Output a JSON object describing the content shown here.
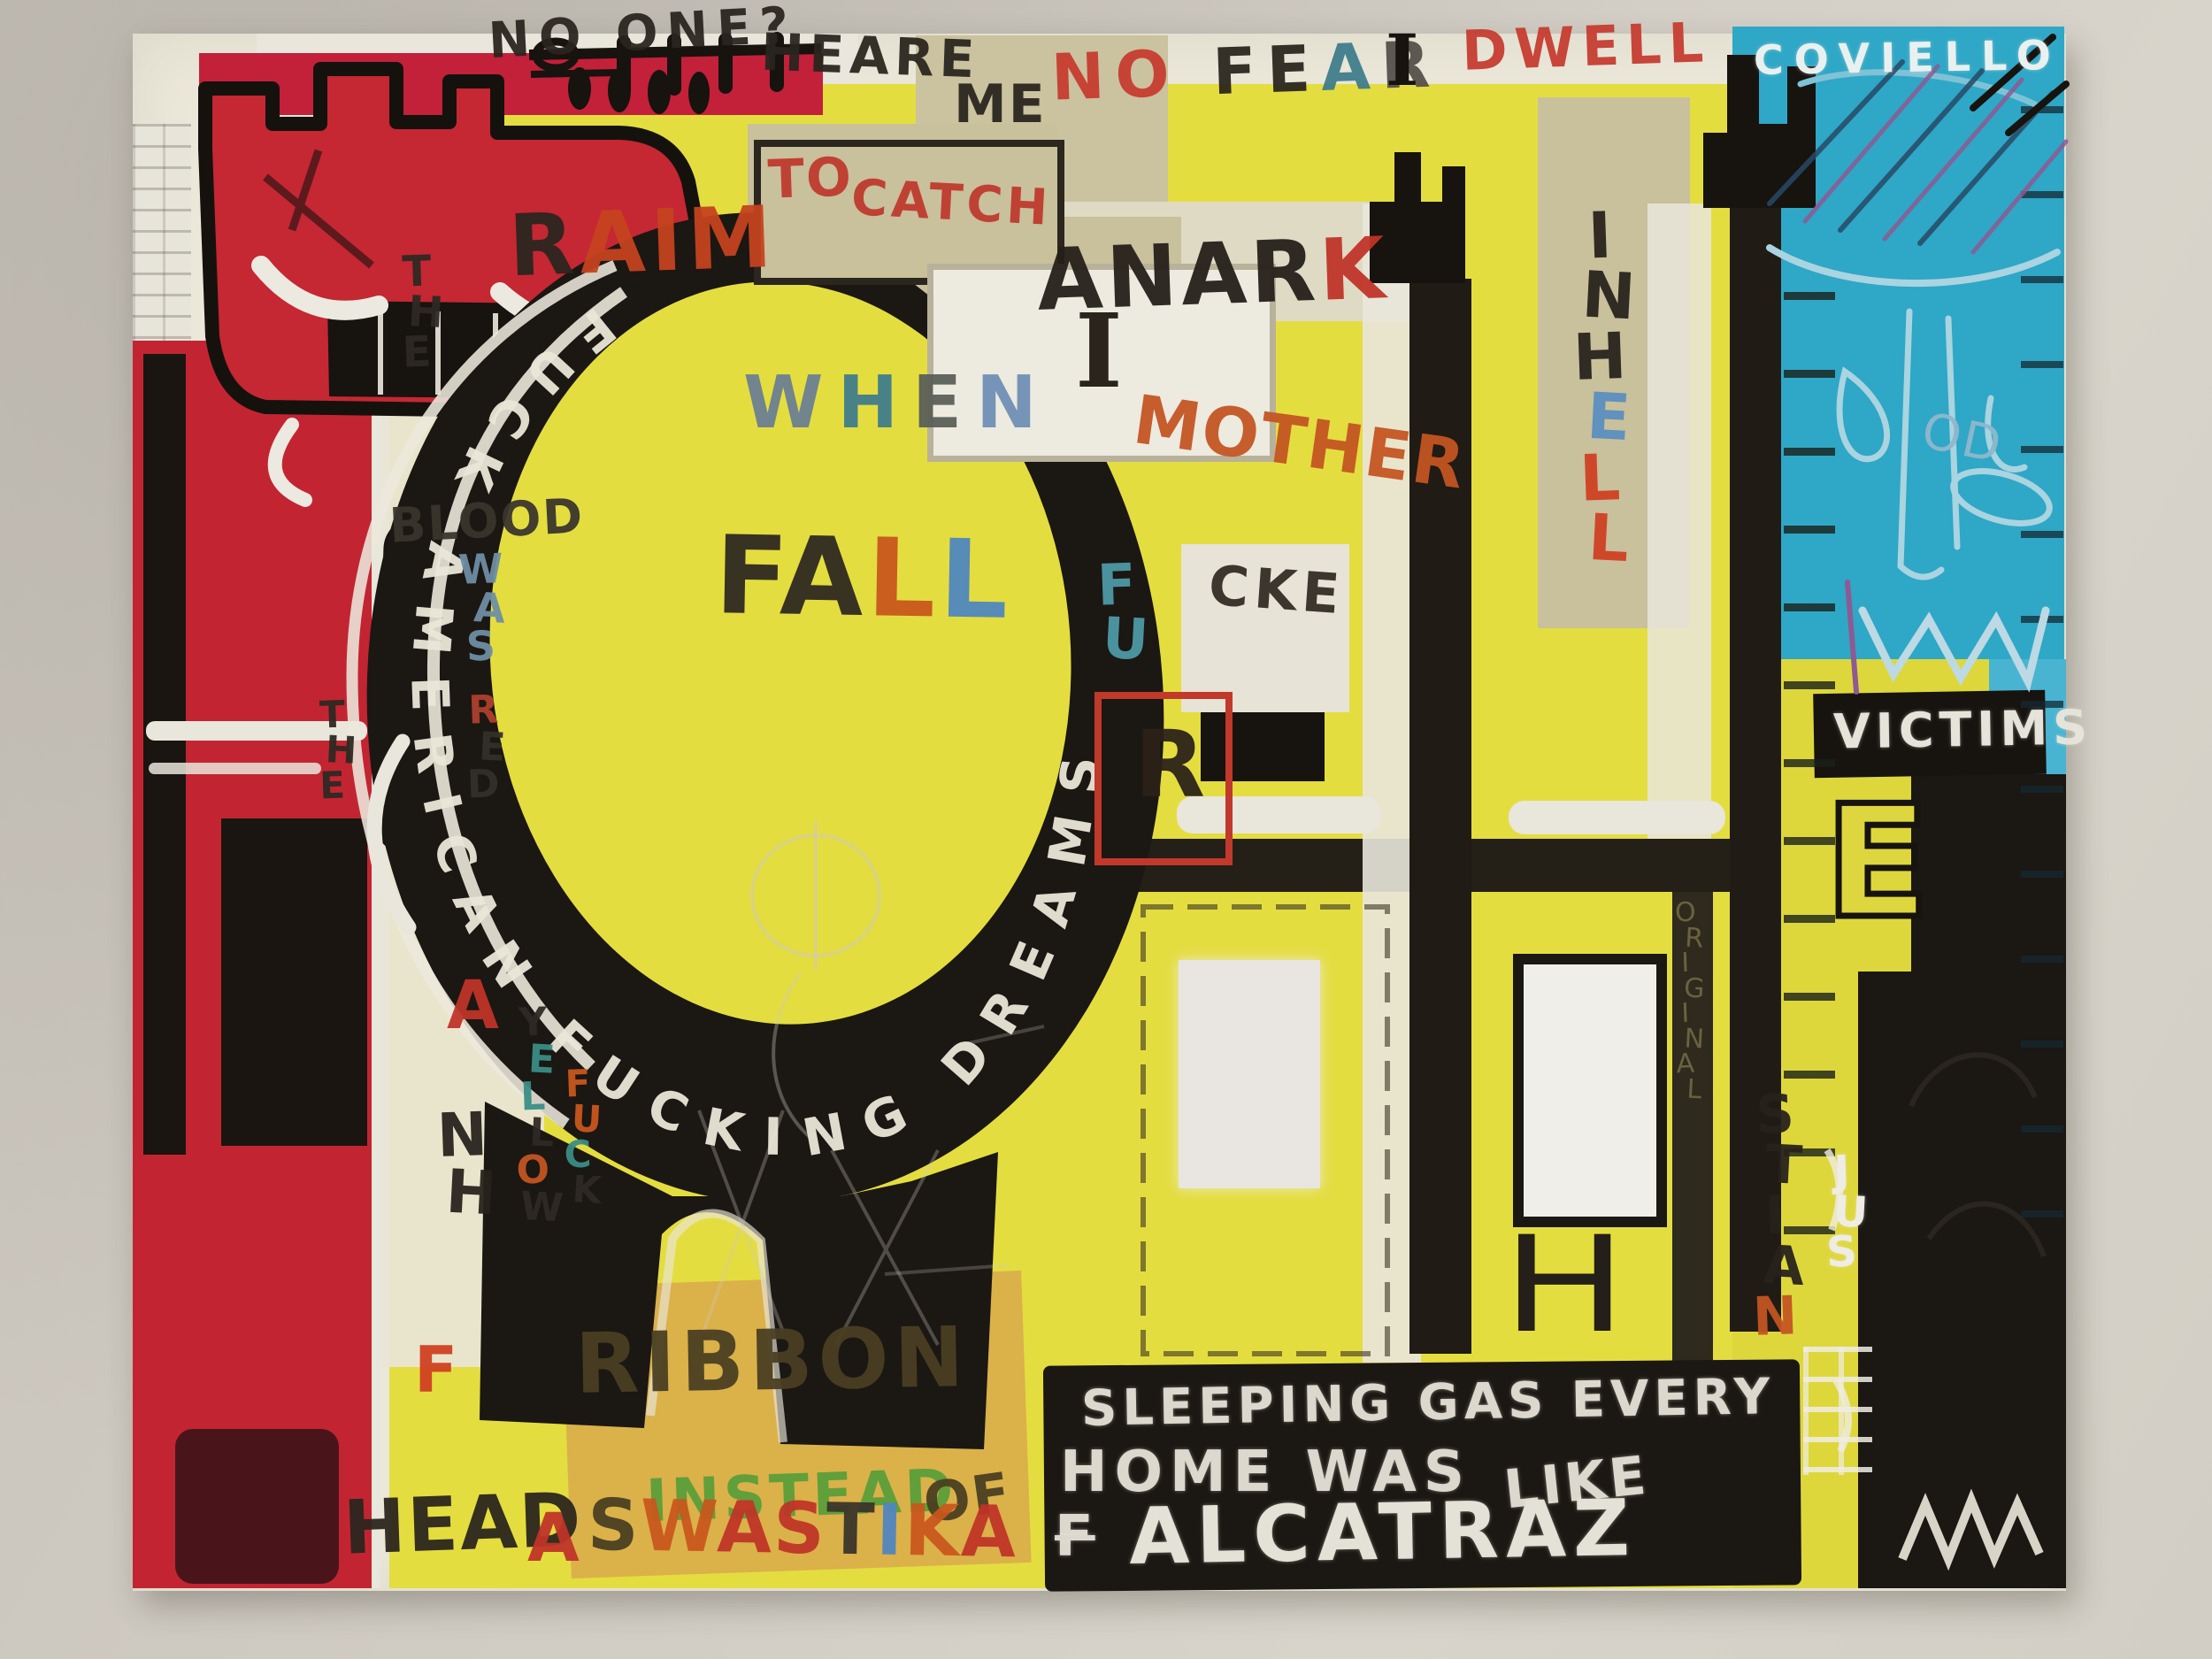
{
  "scene": {
    "description": "Photograph of a neo-expressionist graffiti-style painting (Basquiat-like) hanging on a pale wall",
    "signature": "COVIELLO"
  },
  "palette": {
    "wall": "#cfcac2",
    "gesso_white": "#ebe8da",
    "yellow_field": "#e4dd40",
    "beige": "#c9c09c",
    "red_column": "#c22531",
    "crimson_band": "#c3203a",
    "teal_blue": "#2fa7c7",
    "black": "#1b1713",
    "chalk_white": "#eae6d8",
    "orange": "#c9571d",
    "signal_red": "#c03428",
    "green": "#5a9e3a",
    "letter_blue": "#4f86c0"
  },
  "crescent": {
    "text": "FUCK AMERICAN FUCKING DREAMS",
    "color": "#eae6d8"
  },
  "panel": {
    "line1": {
      "text": "SLEEPING GAS EVERY",
      "color": "#ddd8ce"
    },
    "line2a": {
      "text": "HOME WAS",
      "color": "#ddd8ce"
    },
    "line2b": {
      "text": "LIKE",
      "color": "#ddd8ce"
    },
    "line3_prefix": {
      "text": "F",
      "color": "#ddd8ce"
    },
    "line3": {
      "text": "ALCATRAZ",
      "color": "#e4e1d7"
    }
  },
  "words": {
    "no_one": {
      "text": "NO ONE?",
      "color": "#2a251e"
    },
    "heare": {
      "text": "HEARE",
      "color": "#2a251e"
    },
    "me": {
      "text": "ME",
      "color": "#2a251e"
    },
    "i_tall": {
      "text": "I",
      "color": "#17130f"
    },
    "dwell": {
      "text": "DWELL",
      "color": "#c63c30"
    },
    "coviello": {
      "text": "COVIELLO",
      "color": "#e8f1f0"
    },
    "to": {
      "text": "TO",
      "color": "#bf3a2e"
    },
    "catch": {
      "text": "CATCH",
      "color": "#bf3a2e"
    },
    "i_box": {
      "text": "I",
      "color": "#2a241d"
    },
    "mother": {
      "text": "MOTHER",
      "color": "#c45522"
    },
    "cke": {
      "text": "CKE",
      "color": "#332c24"
    },
    "r_box": {
      "text": "R",
      "color": "#2b2118"
    },
    "blood": {
      "text": "BLOOD",
      "color": "#3a352c"
    },
    "ribbon": {
      "text": "RIBBON",
      "color": "#4a3f22"
    },
    "instead": {
      "text": "INSTEAD",
      "color": "#5a9e3a"
    },
    "of": {
      "text": "OF",
      "color": "#4a3f22"
    },
    "head": {
      "text": "HEAD",
      "color": "#2b251e"
    },
    "a_swastika": {
      "text": "A",
      "color": "#c03428"
    },
    "a_left": {
      "text": "A",
      "color": "#c03428"
    },
    "f_left": {
      "text": "F",
      "color": "#d04022"
    },
    "victims": {
      "text": "VICTIMS",
      "color": "#e6e3da"
    },
    "od": {
      "text": "OD",
      "color": "#8fb8cc"
    },
    "h_mark": {
      "text": "H",
      "color": "#241f18"
    },
    "e_big": {
      "text": "E",
      "color": "#ded63e"
    }
  },
  "letter_words": {
    "no_fear": {
      "letters": [
        {
          "ch": "N",
          "color": "#c63c30"
        },
        {
          "ch": "O",
          "color": "#c63c30"
        },
        {
          "ch": " "
        },
        {
          "ch": "F",
          "color": "#2a251e"
        },
        {
          "ch": "E",
          "color": "#2a251e"
        },
        {
          "ch": "A",
          "color": "#3f7d8c"
        },
        {
          "ch": "R",
          "color": "#555049"
        }
      ]
    },
    "raim": {
      "letters": [
        {
          "ch": "R",
          "color": "#2a251f"
        },
        {
          "ch": "A",
          "color": "#c5431f"
        },
        {
          "ch": "I",
          "color": "#c5431f"
        },
        {
          "ch": "M",
          "color": "#c5431f"
        }
      ]
    },
    "when": {
      "letters": [
        {
          "ch": "W",
          "color": "#6b7f93"
        },
        {
          "ch": "H",
          "color": "#3f7d8c"
        },
        {
          "ch": "E",
          "color": "#5a5f58"
        },
        {
          "ch": "N",
          "color": "#6f8fb5"
        }
      ]
    },
    "fall": {
      "letters": [
        {
          "ch": "F",
          "color": "#2e2822"
        },
        {
          "ch": "A",
          "color": "#2e2822"
        },
        {
          "ch": "L",
          "color": "#c9571d"
        },
        {
          "ch": "L",
          "color": "#4f86c0"
        }
      ]
    },
    "anark": {
      "letters": [
        {
          "ch": "A",
          "color": "#251f1a"
        },
        {
          "ch": "N",
          "color": "#251f1a"
        },
        {
          "ch": "A",
          "color": "#251f1a"
        },
        {
          "ch": "R",
          "color": "#251f1a"
        },
        {
          "ch": "K",
          "color": "#c03428"
        }
      ]
    },
    "swastika": {
      "letters": [
        {
          "ch": "S",
          "color": "#4a3f22"
        },
        {
          "ch": "W",
          "color": "#c9571d"
        },
        {
          "ch": "A",
          "color": "#c03428"
        },
        {
          "ch": "S",
          "color": "#c03428"
        },
        {
          "ch": "T",
          "color": "#3a342b"
        },
        {
          "ch": "I",
          "color": "#4f86c0"
        },
        {
          "ch": "K",
          "color": "#c9571d"
        },
        {
          "ch": "A",
          "color": "#c03428"
        }
      ]
    },
    "fu_vert": {
      "letters": [
        {
          "ch": "F",
          "color": "#4d9aa6"
        },
        {
          "ch": "U",
          "color": "#4d9aa6"
        }
      ]
    },
    "the1_vert": {
      "letters": [
        {
          "ch": "T",
          "color": "#2e2922"
        },
        {
          "ch": "H",
          "color": "#2e2922"
        },
        {
          "ch": "E",
          "color": "#2e2922"
        }
      ]
    },
    "the2_vert": {
      "letters": [
        {
          "ch": "T",
          "color": "#2e2922"
        },
        {
          "ch": "H",
          "color": "#2e2922"
        },
        {
          "ch": "E",
          "color": "#2e2922"
        }
      ]
    },
    "was_vert": {
      "letters": [
        {
          "ch": "W",
          "color": "#6f8fa5"
        },
        {
          "ch": "A",
          "color": "#6f8fa5"
        },
        {
          "ch": "S",
          "color": "#6f8fa5"
        }
      ]
    },
    "red_vert": {
      "letters": [
        {
          "ch": "R",
          "color": "#b0402e"
        },
        {
          "ch": "E",
          "color": "#33302a"
        },
        {
          "ch": "D",
          "color": "#33302a"
        }
      ]
    },
    "yellow_vert": {
      "letters": [
        {
          "ch": "Y",
          "color": "#2f2a24"
        },
        {
          "ch": "E",
          "color": "#3a8e86"
        },
        {
          "ch": "L",
          "color": "#3a8e86"
        },
        {
          "ch": "L",
          "color": "#2f2a24"
        },
        {
          "ch": "O",
          "color": "#c45522"
        },
        {
          "ch": "W",
          "color": "#2f2a24"
        }
      ]
    },
    "fuck_vert": {
      "letters": [
        {
          "ch": "F",
          "color": "#c9571d"
        },
        {
          "ch": "U",
          "color": "#c9571d"
        },
        {
          "ch": "C",
          "color": "#3a8e86"
        },
        {
          "ch": "K",
          "color": "#2f2a24"
        }
      ]
    },
    "nh_vert": {
      "letters": [
        {
          "ch": "N",
          "color": "#27221c"
        },
        {
          "ch": "H",
          "color": "#27221c"
        }
      ]
    },
    "in_hell_vert": {
      "letters": [
        {
          "ch": "I",
          "color": "#27221c"
        },
        {
          "ch": "N",
          "color": "#27221c"
        },
        {
          "ch": "H",
          "color": "#27221c"
        },
        {
          "ch": "E",
          "color": "#5b8fc0"
        },
        {
          "ch": "L",
          "color": "#d04022"
        },
        {
          "ch": "L",
          "color": "#d04022"
        }
      ]
    },
    "stian_vert": {
      "letters": [
        {
          "ch": "S",
          "color": "#27221c"
        },
        {
          "ch": "T",
          "color": "#27221c"
        },
        {
          "ch": "I",
          "color": "#27221c"
        },
        {
          "ch": "A",
          "color": "#27221c"
        },
        {
          "ch": "N",
          "color": "#c45522"
        }
      ]
    },
    "jus_vert": {
      "letters": [
        {
          "ch": "J",
          "color": "#efece4"
        },
        {
          "ch": "U",
          "color": "#efece4"
        },
        {
          "ch": "S",
          "color": "#efece4"
        }
      ]
    },
    "original_vert": {
      "letters": [
        {
          "ch": "O",
          "color": "#8a8150"
        },
        {
          "ch": "R",
          "color": "#8a8150"
        },
        {
          "ch": "I",
          "color": "#8a8150"
        },
        {
          "ch": "G",
          "color": "#8a8150"
        },
        {
          "ch": "I",
          "color": "#8a8150"
        },
        {
          "ch": "N",
          "color": "#8a8150"
        },
        {
          "ch": "A",
          "color": "#8a8150"
        },
        {
          "ch": "L",
          "color": "#8a8150"
        }
      ]
    }
  }
}
